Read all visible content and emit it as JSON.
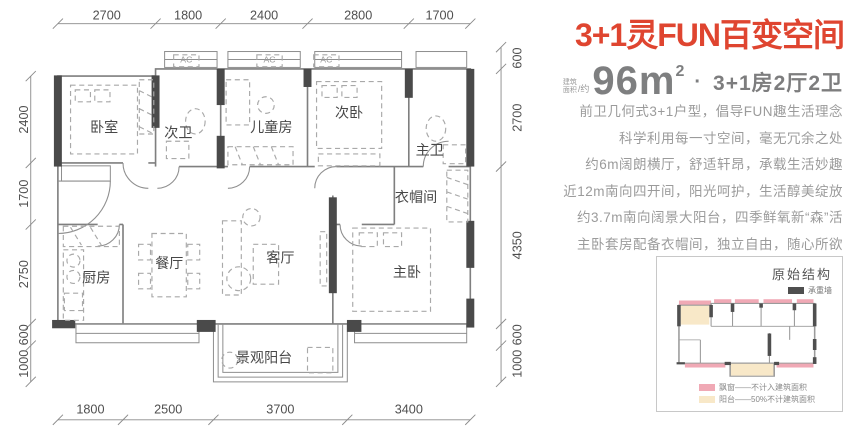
{
  "info": {
    "title": "3+1灵FUN百变空间",
    "area": {
      "label_line1": "建筑",
      "label_line2": "面积",
      "label_suffix": "/约",
      "value": "96m",
      "sup": "2",
      "separator": "·",
      "layout": "3+1房2厅2卫"
    },
    "desc_lines": [
      "前卫几何式3+1户型，倡导FUN趣生活理念",
      "科学利用每一寸空间，毫无冗余之处",
      "约6m阔朗横厅，舒适轩昂，承载生活妙趣",
      "近12m南向四开间，阳光呵护，生活醇美绽放",
      "约3.7m南向阔景大阳台，四季鲜氧新“森”活",
      "主卧套房配备衣帽间，独立自由，随心所欲"
    ]
  },
  "floorplan": {
    "ac_label": "AC",
    "rooms": {
      "bedroom": "卧室",
      "bath2": "次卫",
      "kids": "儿童房",
      "bed2": "次卧",
      "bath1": "主卫",
      "cloak": "衣帽间",
      "kitchen": "厨房",
      "dining": "餐厅",
      "living": "客厅",
      "master": "主卧",
      "balcony": "景观阳台"
    },
    "dims": {
      "top": [
        "2700",
        "1800",
        "2400",
        "2800",
        "1700"
      ],
      "bottom": [
        "1800",
        "2500",
        "3700",
        "3400"
      ],
      "left": [
        "2400",
        "1700",
        "2750",
        "600",
        "1000"
      ],
      "right": [
        "600",
        "2700",
        "4350",
        "600",
        "1000"
      ]
    }
  },
  "inset": {
    "title": "原始结构",
    "bearing_wall_label": "承重墙",
    "legend": [
      {
        "label": "飘窗——不计入建筑面积"
      },
      {
        "label": "阳台——50%不计建筑面积"
      }
    ]
  },
  "colors": {
    "accent_red": "#df4530",
    "area_text_gray": "#7e7f80",
    "desc_text_gray": "#9b9b9b",
    "wall_dark": "#4a4a4a",
    "line_gray": "#8a8a8a",
    "bay_window_pink": "#f0a9b5",
    "balcony_beige": "#f8e8c8"
  }
}
